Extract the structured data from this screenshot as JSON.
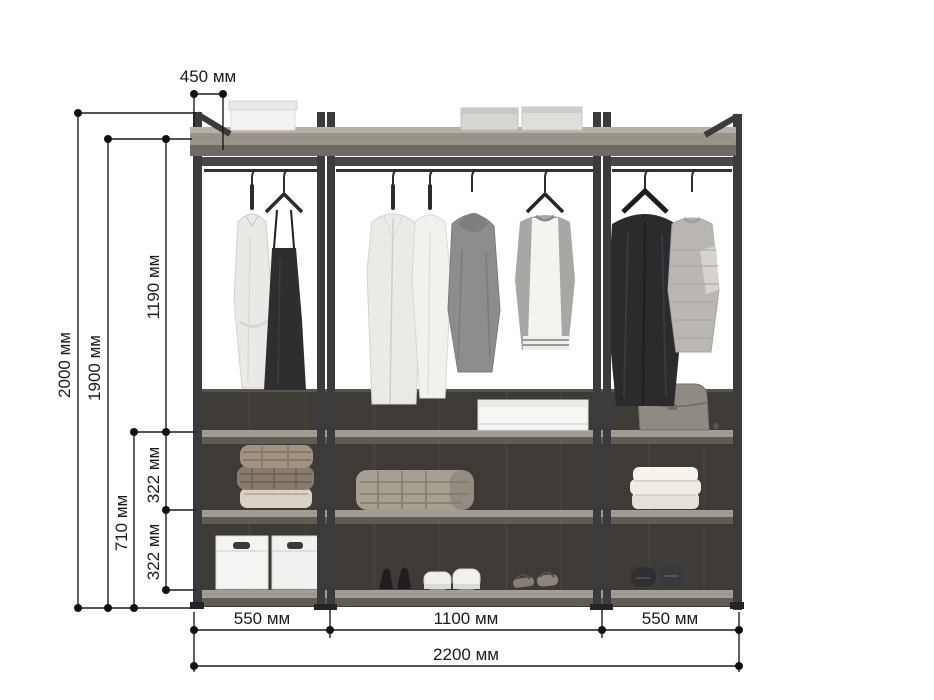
{
  "diagram": {
    "kind": "furniture dimension drawing",
    "subject": "three-section open wardrobe clothing rack with shelves",
    "unit": "мм"
  },
  "dimensions": {
    "depth_top": "450 мм",
    "total_height": "2000 мм",
    "frame_height": "1900 мм",
    "hanging_height": "1190 мм",
    "lower_height": "710 мм",
    "shelf_gap_upper": "322 мм",
    "shelf_gap_lower": "322 мм",
    "left_width": "550 мм",
    "center_width": "1100 мм",
    "right_width": "550 мм",
    "total_width": "2200 мм"
  },
  "colors": {
    "background": "#ffffff",
    "dimension_line": "#1a1a1a",
    "frame_metal": "#3b3b3d",
    "shelf_wood": "#999489",
    "shelf_edge": "#6e6a64",
    "back_panel": "#3e3b37"
  }
}
